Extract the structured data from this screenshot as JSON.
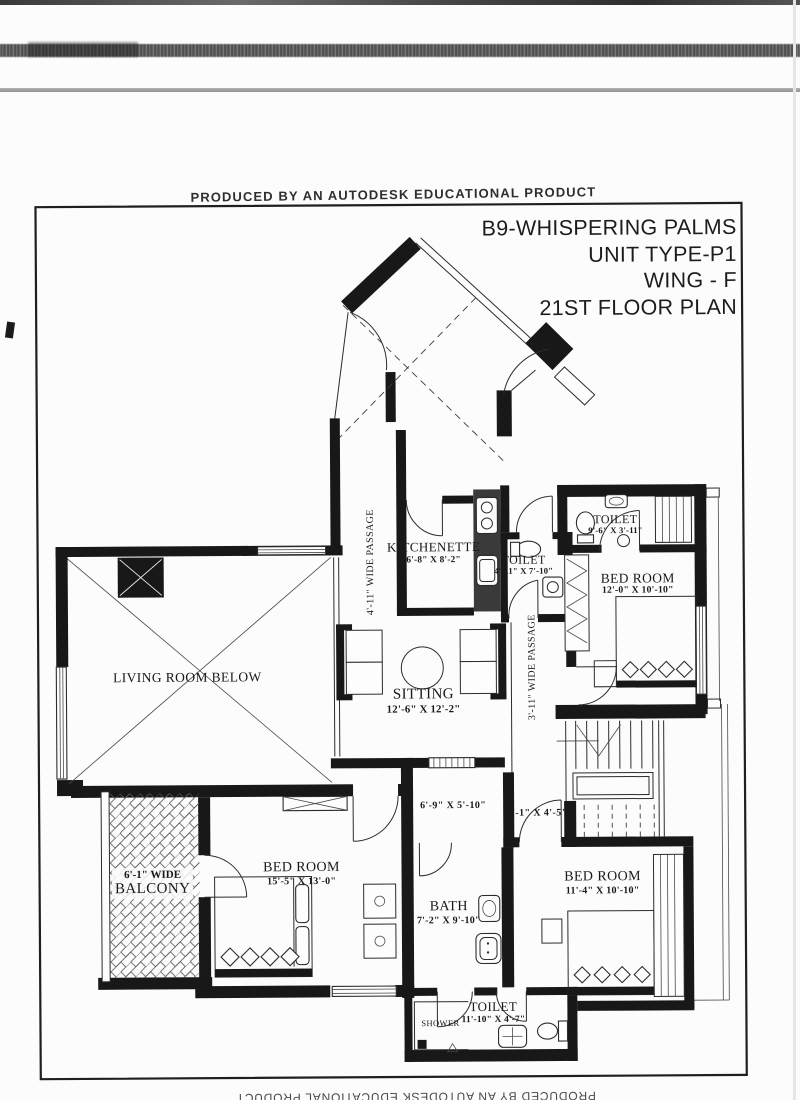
{
  "watermarks": {
    "top": "PRODUCED BY AN AUTODESK EDUCATIONAL PRODUCT",
    "bottom": "PRODUCED BY AN AUTODESK EDUCATIONAL PRODUCT"
  },
  "title_block": {
    "line1": "B9-WHISPERING PALMS",
    "line2": "UNIT TYPE-P1",
    "line3": "WING - F",
    "line4": "21ST FLOOR PLAN"
  },
  "rooms": {
    "kitchenette": {
      "name": "KITCHENETTE",
      "dims": "6'-8\" X 8'-2\""
    },
    "toilet_attached": {
      "name": "TOILET",
      "dims": "4'-11\" X 7'-10\""
    },
    "toilet_master": {
      "name": "TOILET",
      "dims": "9'-6\" X 3'-11\""
    },
    "bedroom_master": {
      "name": "BED ROOM",
      "dims": "12'-0\" X 10'-10\""
    },
    "passage_upper": {
      "name": "4'-11\" WIDE PASSAGE"
    },
    "passage_lower": {
      "name": "3'-11\" WIDE PASSAGE"
    },
    "living_room": {
      "name": "LIVING ROOM BELOW"
    },
    "sitting": {
      "name": "SITTING",
      "dims": "12'-6\" X 12'-2\""
    },
    "foyer": {
      "dims": "6'-9\" X 5'-10\""
    },
    "lobby": {
      "dims": "5'-1\" X 4'-5\""
    },
    "balcony": {
      "width_label": "6'-1\" WIDE",
      "name": "BALCONY"
    },
    "bedroom_left": {
      "name": "BED ROOM",
      "dims": "15'-5\" X 13'-0\""
    },
    "bath": {
      "name": "BATH",
      "dims": "7'-2\" X 9'-10\""
    },
    "bedroom_right": {
      "name": "BED ROOM",
      "dims": "11'-4\" X 10'-10\""
    },
    "toilet_common": {
      "name": "TOILET",
      "dims": "11'-10\" X 4'-7\""
    },
    "shower": {
      "name": "SHOWER"
    }
  }
}
